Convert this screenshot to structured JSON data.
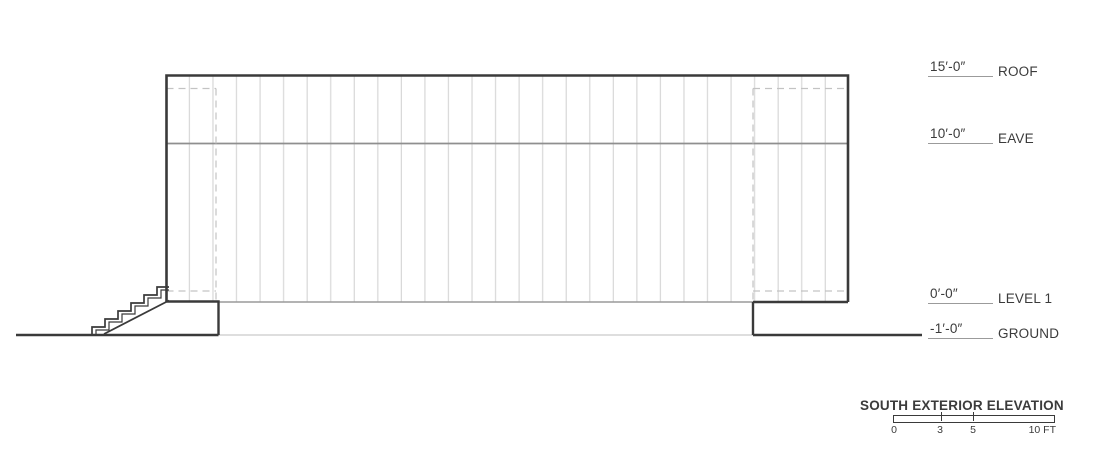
{
  "drawing": {
    "title": "SOUTH EXTERIOR ELEVATION",
    "markers": [
      {
        "value": "15′-0″",
        "label": "ROOF"
      },
      {
        "value": "10′-0″",
        "label": "EAVE"
      },
      {
        "value": "0′-0″",
        "label": "LEVEL 1"
      },
      {
        "value": "-1′-0″",
        "label": "GROUND"
      }
    ],
    "scalebar": {
      "labels": [
        "0",
        "3",
        "5",
        "10 FT"
      ],
      "ticks_ft": [
        0,
        3,
        5,
        10
      ]
    },
    "colors": {
      "ink": "#3a3a3a",
      "line_medium": "#8f8f8f",
      "line_light": "#d9d9d9",
      "dashed": "#c3c3c3"
    }
  }
}
